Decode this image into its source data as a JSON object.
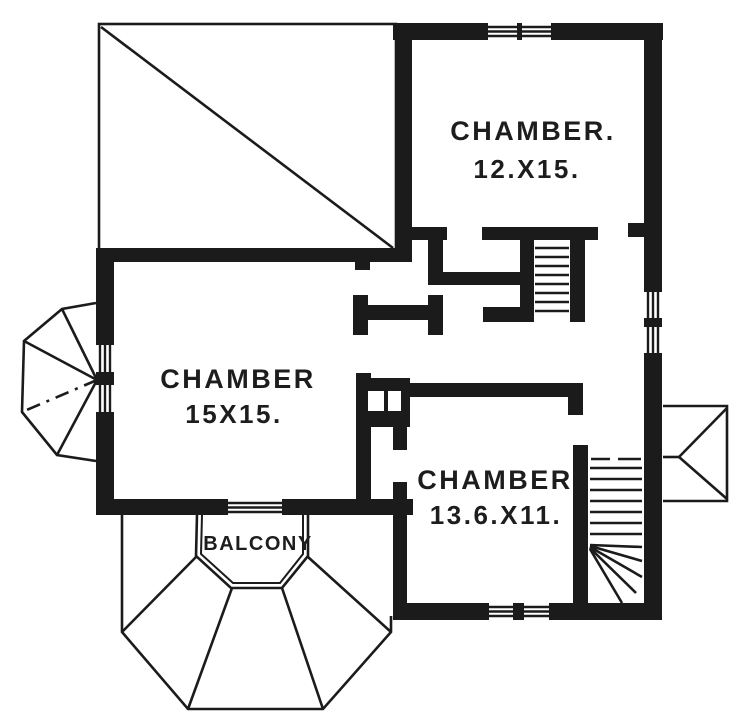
{
  "colors": {
    "ink": "#1b1b1b",
    "paper": "#ffffff"
  },
  "rooms": {
    "chamber_top_right": {
      "label": "CHAMBER.",
      "dimensions": "12.X15."
    },
    "chamber_left": {
      "label": "CHAMBER",
      "dimensions": "15X15."
    },
    "chamber_bottom": {
      "label": "CHAMBER",
      "dimensions": "13.6.X11."
    },
    "balcony": {
      "label": "BALCONY"
    }
  }
}
